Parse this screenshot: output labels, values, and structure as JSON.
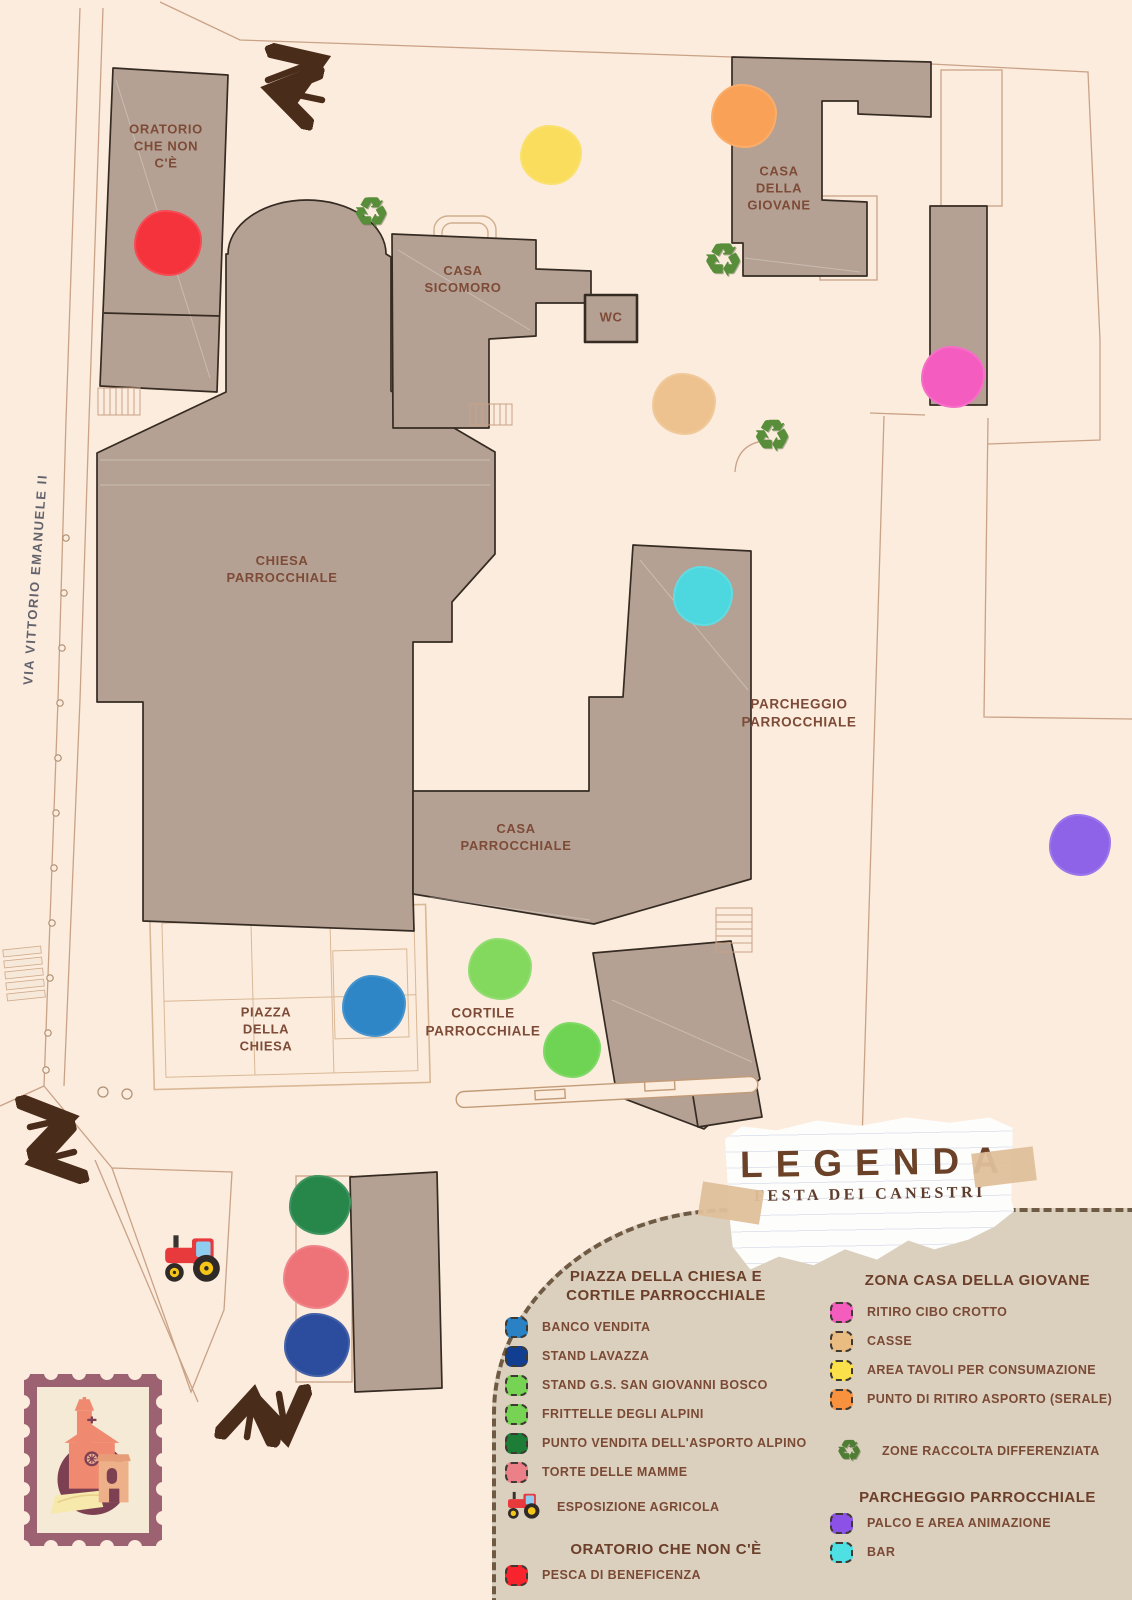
{
  "map": {
    "street_name": "VIA VITTORIO EMANUELE II",
    "buildings": {
      "oratorio": {
        "label": "ORATORIO\nCHE NON\nC'È"
      },
      "chiesa": {
        "label": "CHIESA\nPARROCCHIALE"
      },
      "casa_sicomoro": {
        "label": "CASA\nSICOMORO"
      },
      "wc": {
        "label": "WC"
      },
      "casa_della_giovane": {
        "label": "CASA\nDELLA\nGIOVANE"
      },
      "parcheggio": {
        "label": "PARCHEGGIO\nPARROCCHIALE"
      },
      "casa_parrocchiale": {
        "label": "CASA\nPARROCCHIALE"
      },
      "piazza": {
        "label": "PIAZZA\nDELLA\nCHIESA"
      },
      "cortile": {
        "label": "CORTILE\nPARROCCHIALE"
      }
    },
    "markers": {
      "pesca_di_beneficenza": {
        "color": "#f5333d"
      },
      "area_tavoli_per_consumazione": {
        "color": "#fadd5c"
      },
      "punto_ritiro_asporto_serale": {
        "color": "#f9a257"
      },
      "ritiro_cibo_crotto": {
        "color": "#f45cc0"
      },
      "casse": {
        "color": "#eec28e"
      },
      "bar": {
        "color": "#4dd7de"
      },
      "palco_e_area_animazione": {
        "color": "#8f63e8"
      },
      "banco_vendita": {
        "color": "#2e86c6"
      },
      "stand_gs_san_giovanni_bosco": {
        "color": "#83d85e"
      },
      "frittelle_degli_alpini": {
        "color": "#6fd453"
      },
      "punto_vendita_asporto_alpino": {
        "color": "#27874a"
      },
      "torte_delle_mamme": {
        "color": "#ee7379"
      },
      "stand_lavazza": {
        "color": "#2c4d9d"
      }
    },
    "icons": {
      "recycle_glyph": "♻"
    },
    "colors": {
      "building_fill": "#b5a193",
      "background": "#fcecdd",
      "arrow": "#4a2c1b"
    }
  },
  "legend": {
    "title": "LEGENDA",
    "subtitle": "FESTA DEI CANESTRI",
    "sections": [
      {
        "heading": "PIAZZA DELLA CHIESA E\nCORTILE PARROCCHIALE",
        "items": [
          {
            "label": "BANCO VENDITA",
            "color": "#2a82c4"
          },
          {
            "label": "STAND LAVAZZA",
            "color": "#123e91"
          },
          {
            "label": "STAND G.S. SAN GIOVANNI BOSCO",
            "color": "#77d353"
          },
          {
            "label": "FRITTELLE DEGLI ALPINI",
            "color": "#77d353"
          },
          {
            "label": "PUNTO VENDITA DELL'ASPORTO ALPINO",
            "color": "#1d7c35"
          },
          {
            "label": "TORTE DELLE MAMME",
            "color": "#ec8089"
          },
          {
            "label": "ESPOSIZIONE AGRICOLA",
            "icon": "tractor-icon"
          }
        ]
      },
      {
        "heading": "ORATORIO CHE NON C'È",
        "items": [
          {
            "label": "PESCA DI BENEFICENZA",
            "color": "#f8242d"
          }
        ]
      },
      {
        "heading": "ZONA CASA DELLA GIOVANE",
        "items": [
          {
            "label": "RITIRO CIBO CROTTO",
            "color": "#f45cbe"
          },
          {
            "label": "CASSE",
            "color": "#e9bc82"
          },
          {
            "label": "AREA TAVOLI PER CONSUMAZIONE",
            "color": "#fbe04b"
          },
          {
            "label": "PUNTO DI RITIRO ASPORTO (SERALE)",
            "color": "#f9923f"
          },
          {
            "label": "ZONE RACCOLTA DIFFERENZIATA",
            "icon": "recycle-icon"
          }
        ]
      },
      {
        "heading": "PARCHEGGIO PARROCCHIALE",
        "items": [
          {
            "label": "PALCO E AREA ANIMAZIONE",
            "color": "#8c52e8"
          },
          {
            "label": "BAR",
            "color": "#4fe0e4"
          }
        ]
      }
    ]
  }
}
